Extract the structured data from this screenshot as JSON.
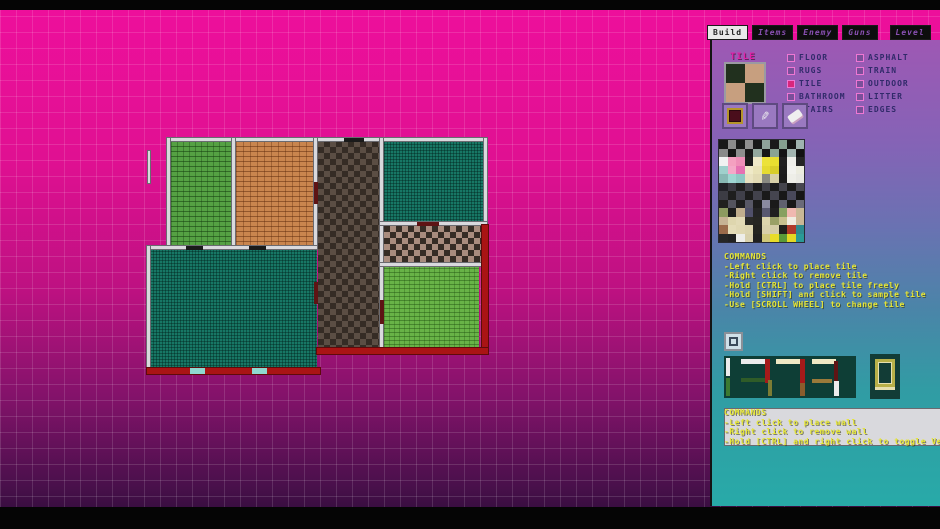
{
  "tabs": [
    {
      "label": "Build",
      "active": true
    },
    {
      "label": "Items",
      "active": false
    },
    {
      "label": "Enemy",
      "active": false
    },
    {
      "label": "Guns",
      "active": false
    },
    {
      "label": "Level",
      "active": false
    }
  ],
  "tile_section": {
    "label": "TILE",
    "preview_colors": [
      "#21301e",
      "#c79f7f",
      "#c79f7f",
      "#21301e"
    ],
    "tools": [
      "fill-tool",
      "eyedropper-tool",
      "eraser-tool"
    ],
    "columns": [
      [
        {
          "label": "FLOOR",
          "checked": false
        },
        {
          "label": "RUGS",
          "checked": false
        },
        {
          "label": "TILE",
          "checked": true
        },
        {
          "label": "BATHROOM",
          "checked": false
        },
        {
          "label": "STAIRS",
          "checked": false
        }
      ],
      [
        {
          "label": "ASPHALT",
          "checked": false
        },
        {
          "label": "TRAIN",
          "checked": false
        },
        {
          "label": "OUTDOOR",
          "checked": false
        },
        {
          "label": "LITTER",
          "checked": false
        },
        {
          "label": "EDGES",
          "checked": false
        }
      ]
    ]
  },
  "palette": {
    "rows": [
      [
        "#181818",
        "#8c8c8c",
        "#1a1a1a",
        "#909090",
        "#181818",
        "#8fa39b",
        "#1a1a1a",
        "#85a08f",
        "#151515",
        "#9fb3af"
      ],
      [
        "#8a8a8a",
        "#161616",
        "#8e8e8e",
        "#181818",
        "#93a89e",
        "#161616",
        "#8aa392",
        "#141414",
        "#a2b5b0",
        "#121212"
      ],
      [
        "#f2f2f2",
        "#f4a0c0",
        "#ef8fb8",
        "#1c1c1c",
        "#efe9c8",
        "#ece23a",
        "#e8de30",
        "#202020",
        "#efefea",
        "#242424"
      ],
      [
        "#9fd0cc",
        "#f4a8c8",
        "#e671b2",
        "#efe9c8",
        "#e9e2b8",
        "#e5da32",
        "#d8cd2a",
        "#1e1e1e",
        "#f2f2ee",
        "#ececdf"
      ],
      [
        "#88b8b4",
        "#9fd6d2",
        "#8fc8c4",
        "#e9e2c0",
        "#e2dab4",
        "#8a8a82",
        "#d8d0a8",
        "#1c1c1c",
        "#eeeee8",
        "#e8e8e2"
      ],
      [
        "#222228",
        "#3a3a42",
        "#202020",
        "#42424a",
        "#1e1e1e",
        "#3f3f47",
        "#1d1d1d",
        "#44444c",
        "#1b1b1b",
        "#47474f"
      ],
      [
        "#3c3c44",
        "#1e1e1e",
        "#40404a",
        "#1c1c1c",
        "#42424c",
        "#1a1a1a",
        "#45454f",
        "#181818",
        "#48485a",
        "#161616"
      ],
      [
        "#20201e",
        "#54545e",
        "#1e1e1e",
        "#585866",
        "#1c1c1c",
        "#8a8aa0",
        "#1a1a1a",
        "#60606e",
        "#181818",
        "#6a6a78"
      ],
      [
        "#8c9a60",
        "#1e1e1e",
        "#c0ae8e",
        "#50506a",
        "#242424",
        "#585870",
        "#202020",
        "#86a060",
        "#f0b8b0",
        "#c8b896"
      ],
      [
        "#c6b294",
        "#ded6ae",
        "#e2dab6",
        "#2a2a26",
        "#262622",
        "#dcd4ac",
        "#9aa066",
        "#c8c08e",
        "#f0ece0",
        "#cbb795"
      ],
      [
        "#9a6a4a",
        "#e4dcb8",
        "#e0d8b2",
        "#dcd4ae",
        "#242420",
        "#d8d0aa",
        "#d4cca6",
        "#20201c",
        "#b03a2a",
        "#2e8a8e"
      ],
      [
        "#262626",
        "#222222",
        "#eeeeea",
        "#d8d0ac",
        "#202020",
        "#d0c87a",
        "#e8dc28",
        "#5a9a38",
        "#e4d824",
        "#2a9a96"
      ]
    ]
  },
  "tile_commands": {
    "title": "COMMANDS",
    "lines": [
      "-Left click to place tile",
      "-Right click to remove tile",
      "-Hold [CTRL] to place tile freely",
      "-Hold [SHIFT] and click to sample tile",
      "-Use [SCROLL WHEEL] to change tile"
    ]
  },
  "wall_commands": {
    "title": "COMMANDS",
    "lines": [
      "-Left click to place wall",
      "-Right click to remove wall",
      "-Hold [CTRL] and right click to toggle Vert/Hor"
    ]
  },
  "wall_section": {
    "icon": "wall-mode-icon",
    "segments": [
      {
        "x": 2,
        "y": 2,
        "w": 4,
        "h": 18,
        "color": "#ececec"
      },
      {
        "x": 2,
        "y": 22,
        "w": 4,
        "h": 18,
        "color": "#3c7a30"
      },
      {
        "x": 17,
        "y": 3,
        "w": 24,
        "h": 5,
        "color": "#ececec"
      },
      {
        "x": 41,
        "y": 3,
        "w": 5,
        "h": 24,
        "color": "#a51a1a"
      },
      {
        "x": 17,
        "y": 22,
        "w": 24,
        "h": 4,
        "color": "#2f5c28"
      },
      {
        "x": 44,
        "y": 24,
        "w": 4,
        "h": 16,
        "color": "#7c7c34"
      },
      {
        "x": 52,
        "y": 3,
        "w": 24,
        "h": 5,
        "color": "#efe9c4"
      },
      {
        "x": 76,
        "y": 3,
        "w": 5,
        "h": 24,
        "color": "#a51a1a"
      },
      {
        "x": 76,
        "y": 27,
        "w": 5,
        "h": 13,
        "color": "#8a5c2c"
      },
      {
        "x": 88,
        "y": 3,
        "w": 24,
        "h": 5,
        "color": "#efe9c4"
      },
      {
        "x": 110,
        "y": 5,
        "w": 4,
        "h": 20,
        "color": "#5e1414"
      },
      {
        "x": 88,
        "y": 23,
        "w": 20,
        "h": 4,
        "color": "#9a7a3a"
      },
      {
        "x": 110,
        "y": 25,
        "w": 5,
        "h": 15,
        "color": "#ececec"
      }
    ]
  },
  "map": {
    "rooms": [
      {
        "name": "green-brick-room",
        "x": 171,
        "y": 141,
        "w": 61,
        "h": 106,
        "pattern": "green-brick"
      },
      {
        "name": "orange-brick-room",
        "x": 236,
        "y": 141,
        "w": 79,
        "h": 106,
        "pattern": "orange-brick"
      },
      {
        "name": "dark-checker-hall",
        "x": 318,
        "y": 141,
        "w": 63,
        "h": 210,
        "pattern": "dark-checker"
      },
      {
        "name": "teal-room-top",
        "x": 384,
        "y": 141,
        "w": 99,
        "h": 82,
        "pattern": "teal"
      },
      {
        "name": "pink-checker-hall",
        "x": 384,
        "y": 226,
        "w": 99,
        "h": 38,
        "pattern": "pink-checker"
      },
      {
        "name": "light-green-room",
        "x": 384,
        "y": 267,
        "w": 95,
        "h": 82,
        "pattern": "light-green"
      },
      {
        "name": "teal-room-bottom",
        "x": 150,
        "y": 250,
        "w": 167,
        "h": 119,
        "pattern": "teal"
      }
    ],
    "walls": [
      {
        "x": 166,
        "y": 137,
        "w": 322,
        "h": 5
      },
      {
        "x": 166,
        "y": 137,
        "w": 5,
        "h": 110
      },
      {
        "x": 231,
        "y": 137,
        "w": 5,
        "h": 111
      },
      {
        "x": 313,
        "y": 137,
        "w": 5,
        "h": 111
      },
      {
        "x": 379,
        "y": 137,
        "w": 5,
        "h": 215
      },
      {
        "x": 483,
        "y": 137,
        "w": 5,
        "h": 89
      },
      {
        "x": 146,
        "y": 245,
        "w": 172,
        "h": 5
      },
      {
        "x": 146,
        "y": 245,
        "w": 5,
        "h": 127
      },
      {
        "x": 379,
        "y": 221,
        "w": 109,
        "h": 5
      },
      {
        "x": 379,
        "y": 262,
        "w": 109,
        "h": 5
      },
      {
        "x": 147,
        "y": 150,
        "w": 4,
        "h": 34
      }
    ],
    "red_walls": [
      {
        "x": 481,
        "y": 224,
        "w": 8,
        "h": 131
      },
      {
        "x": 316,
        "y": 347,
        "w": 173,
        "h": 8
      },
      {
        "x": 146,
        "y": 367,
        "w": 175,
        "h": 8
      }
    ],
    "doors": [
      {
        "x": 314,
        "y": 182,
        "w": 4,
        "h": 22,
        "color": "#5e1414"
      },
      {
        "x": 314,
        "y": 282,
        "w": 4,
        "h": 22,
        "color": "#5e1414"
      },
      {
        "x": 417,
        "y": 222,
        "w": 22,
        "h": 4,
        "color": "#5e1414"
      },
      {
        "x": 380,
        "y": 300,
        "w": 4,
        "h": 24,
        "color": "#5e1414"
      },
      {
        "x": 186,
        "y": 246,
        "w": 17,
        "h": 4,
        "color": "#1a1a1a"
      },
      {
        "x": 249,
        "y": 246,
        "w": 17,
        "h": 4,
        "color": "#1a1a1a"
      },
      {
        "x": 344,
        "y": 138,
        "w": 20,
        "h": 4,
        "color": "#1a1a1a"
      },
      {
        "x": 190,
        "y": 368,
        "w": 15,
        "h": 6,
        "color": "#8fd8d0"
      },
      {
        "x": 252,
        "y": 368,
        "w": 15,
        "h": 6,
        "color": "#8fd8d0"
      }
    ]
  },
  "colors": {
    "background_top": "#ee0f9c",
    "background_bottom": "#2a0b36",
    "panel_top": "#9e58b4",
    "panel_bottom": "#28aaa8",
    "command_text": "#e6e636",
    "category_text": "#312a6a",
    "tile_label_text": "#e023a8",
    "wall_red": "#a91414",
    "wall_white": "#d9d9dd"
  }
}
